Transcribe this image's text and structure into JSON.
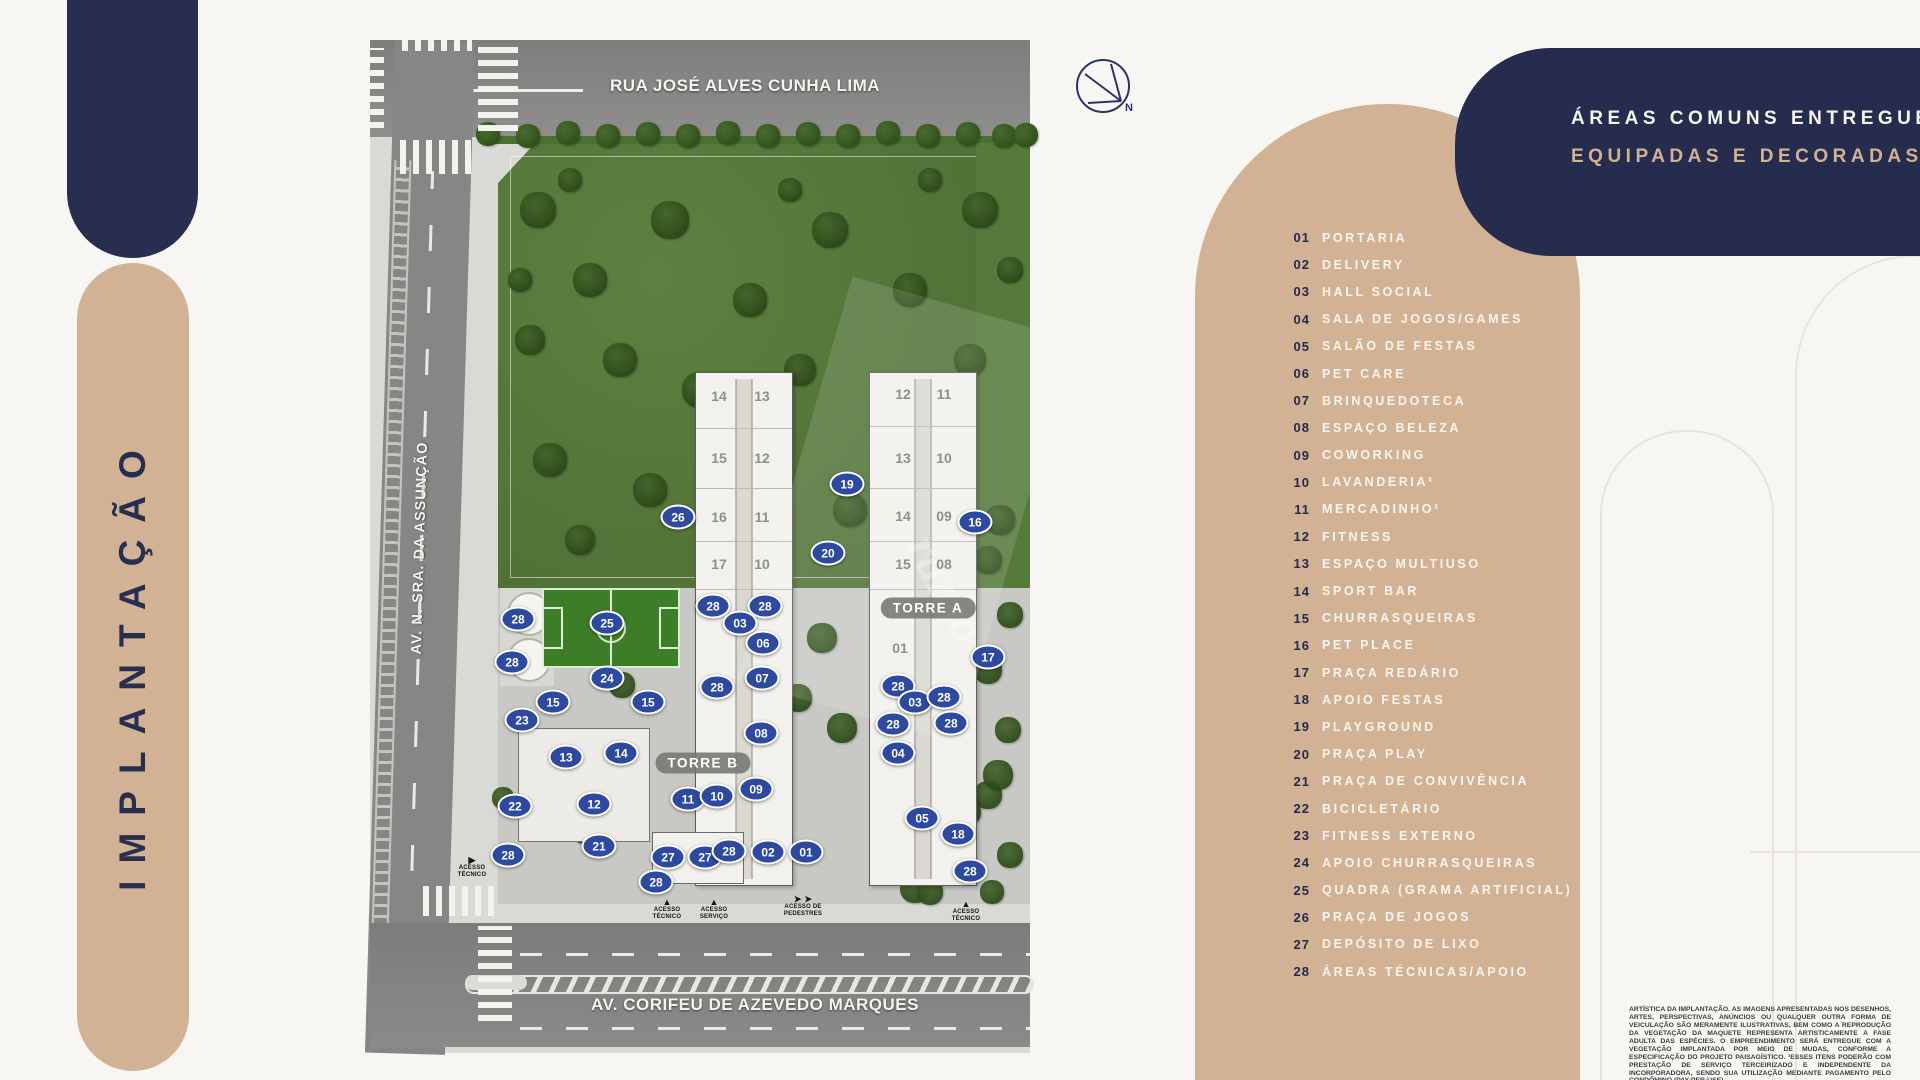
{
  "page": {
    "vertical_title": "IMPLANTAÇÃO"
  },
  "colors": {
    "navy": "#272e50",
    "tan": "#d2b294",
    "marker_blue": "#2d4a9e",
    "lawn_green": "#567a3b"
  },
  "header_card": {
    "line1": "ÁREAS COMUNS ENTREGUES",
    "line2": "EQUIPADAS E DECORADAS."
  },
  "compass": {
    "label": "N"
  },
  "legend": {
    "items": [
      {
        "num": "01",
        "label": "PORTARIA"
      },
      {
        "num": "02",
        "label": "DELIVERY"
      },
      {
        "num": "03",
        "label": "HALL SOCIAL"
      },
      {
        "num": "04",
        "label": "SALA DE JOGOS/GAMES"
      },
      {
        "num": "05",
        "label": "SALÃO DE FESTAS"
      },
      {
        "num": "06",
        "label": "PET CARE"
      },
      {
        "num": "07",
        "label": "BRINQUEDOTECA"
      },
      {
        "num": "08",
        "label": "ESPAÇO BELEZA"
      },
      {
        "num": "09",
        "label": "COWORKING"
      },
      {
        "num": "10",
        "label": "LAVANDERIA¹"
      },
      {
        "num": "11",
        "label": "MERCADINHO¹"
      },
      {
        "num": "12",
        "label": "FITNESS"
      },
      {
        "num": "13",
        "label": "ESPAÇO MULTIUSO"
      },
      {
        "num": "14",
        "label": "SPORT BAR"
      },
      {
        "num": "15",
        "label": "CHURRASQUEIRAS"
      },
      {
        "num": "16",
        "label": "PET PLACE"
      },
      {
        "num": "17",
        "label": "PRAÇA REDÁRIO"
      },
      {
        "num": "18",
        "label": "APOIO FESTAS"
      },
      {
        "num": "19",
        "label": "PLAYGROUND"
      },
      {
        "num": "20",
        "label": "PRAÇA PLAY"
      },
      {
        "num": "21",
        "label": "PRAÇA DE CONVIVÊNCIA"
      },
      {
        "num": "22",
        "label": "BICICLETÁRIO"
      },
      {
        "num": "23",
        "label": "FITNESS EXTERNO"
      },
      {
        "num": "24",
        "label": "APOIO CHURRASQUEIRAS"
      },
      {
        "num": "25",
        "label": "QUADRA (GRAMA ARTIFICIAL)"
      },
      {
        "num": "26",
        "label": "PRAÇA DE JOGOS"
      },
      {
        "num": "27",
        "label": "DEPÓSITO DE LIXO"
      },
      {
        "num": "28",
        "label": "ÁREAS TÉCNICAS/APOIO"
      }
    ]
  },
  "map": {
    "streets": {
      "top": "RUA JOSÉ ALVES CUNHA LIMA",
      "left": "AV. N. SRA. DA ASSUNÇÃO",
      "bottom": "AV. CORIFEU DE AZEVEDO MARQUES"
    },
    "watermark": "razão",
    "tower_labels": [
      {
        "name": "TORRE B",
        "x": 333,
        "y": 723
      },
      {
        "name": "TORRE A",
        "x": 558,
        "y": 568
      }
    ],
    "units": [
      {
        "t": "14",
        "x": 349,
        "y": 356
      },
      {
        "t": "13",
        "x": 392,
        "y": 356
      },
      {
        "t": "15",
        "x": 349,
        "y": 418
      },
      {
        "t": "12",
        "x": 392,
        "y": 418
      },
      {
        "t": "16",
        "x": 349,
        "y": 477
      },
      {
        "t": "11",
        "x": 392,
        "y": 477
      },
      {
        "t": "17",
        "x": 349,
        "y": 524
      },
      {
        "t": "10",
        "x": 392,
        "y": 524
      },
      {
        "t": "12",
        "x": 533,
        "y": 354
      },
      {
        "t": "11",
        "x": 574,
        "y": 354
      },
      {
        "t": "13",
        "x": 533,
        "y": 418
      },
      {
        "t": "10",
        "x": 574,
        "y": 418
      },
      {
        "t": "14",
        "x": 533,
        "y": 476
      },
      {
        "t": "09",
        "x": 574,
        "y": 476
      },
      {
        "t": "15",
        "x": 533,
        "y": 524
      },
      {
        "t": "08",
        "x": 574,
        "y": 524
      },
      {
        "t": "01",
        "x": 530,
        "y": 608
      }
    ],
    "markers": [
      {
        "n": "26",
        "x": 308,
        "y": 477
      },
      {
        "n": "19",
        "x": 477,
        "y": 444
      },
      {
        "n": "20",
        "x": 458,
        "y": 513
      },
      {
        "n": "16",
        "x": 605,
        "y": 482
      },
      {
        "n": "28",
        "x": 343,
        "y": 566
      },
      {
        "n": "28",
        "x": 395,
        "y": 566
      },
      {
        "n": "03",
        "x": 370,
        "y": 583
      },
      {
        "n": "06",
        "x": 393,
        "y": 603
      },
      {
        "n": "28",
        "x": 347,
        "y": 647
      },
      {
        "n": "07",
        "x": 392,
        "y": 638
      },
      {
        "n": "08",
        "x": 391,
        "y": 693
      },
      {
        "n": "09",
        "x": 386,
        "y": 749
      },
      {
        "n": "11",
        "x": 318,
        "y": 759
      },
      {
        "n": "10",
        "x": 347,
        "y": 756
      },
      {
        "n": "28",
        "x": 148,
        "y": 579
      },
      {
        "n": "25",
        "x": 237,
        "y": 583
      },
      {
        "n": "28",
        "x": 142,
        "y": 622
      },
      {
        "n": "24",
        "x": 237,
        "y": 638
      },
      {
        "n": "15",
        "x": 183,
        "y": 662
      },
      {
        "n": "15",
        "x": 278,
        "y": 662
      },
      {
        "n": "23",
        "x": 152,
        "y": 680
      },
      {
        "n": "13",
        "x": 196,
        "y": 717
      },
      {
        "n": "14",
        "x": 251,
        "y": 713
      },
      {
        "n": "22",
        "x": 145,
        "y": 766
      },
      {
        "n": "12",
        "x": 224,
        "y": 764
      },
      {
        "n": "21",
        "x": 229,
        "y": 806
      },
      {
        "n": "28",
        "x": 138,
        "y": 815
      },
      {
        "n": "27",
        "x": 298,
        "y": 817
      },
      {
        "n": "27",
        "x": 335,
        "y": 817
      },
      {
        "n": "28",
        "x": 359,
        "y": 811
      },
      {
        "n": "02",
        "x": 398,
        "y": 812
      },
      {
        "n": "01",
        "x": 436,
        "y": 812
      },
      {
        "n": "28",
        "x": 286,
        "y": 842
      },
      {
        "n": "17",
        "x": 618,
        "y": 617
      },
      {
        "n": "28",
        "x": 528,
        "y": 646
      },
      {
        "n": "03",
        "x": 545,
        "y": 662
      },
      {
        "n": "28",
        "x": 574,
        "y": 657
      },
      {
        "n": "28",
        "x": 523,
        "y": 684
      },
      {
        "n": "28",
        "x": 581,
        "y": 683
      },
      {
        "n": "04",
        "x": 528,
        "y": 713
      },
      {
        "n": "05",
        "x": 552,
        "y": 778
      },
      {
        "n": "18",
        "x": 588,
        "y": 794
      },
      {
        "n": "28",
        "x": 600,
        "y": 831
      }
    ],
    "access": [
      {
        "text": "ACESSO\nTÉCNICO",
        "x": 102,
        "y": 816,
        "arrow": "right"
      },
      {
        "text": "ACESSO\nTÉCNICO",
        "x": 297,
        "y": 858,
        "arrow": "up"
      },
      {
        "text": "ACESSO\nSERVIÇO",
        "x": 344,
        "y": 858,
        "arrow": "up"
      },
      {
        "text": "ACESSO DE\nPEDESTRES",
        "x": 433,
        "y": 855,
        "arrow": "lr"
      },
      {
        "text": "ACESSO\nTÉCNICO",
        "x": 596,
        "y": 860,
        "arrow": "up"
      }
    ],
    "trees": [
      [
        118,
        94,
        24,
        0
      ],
      [
        158,
        96,
        24,
        0
      ],
      [
        198,
        93,
        24,
        0
      ],
      [
        238,
        96,
        24,
        0
      ],
      [
        278,
        94,
        24,
        0
      ],
      [
        318,
        96,
        24,
        0
      ],
      [
        358,
        93,
        24,
        0
      ],
      [
        398,
        96,
        24,
        0
      ],
      [
        438,
        94,
        24,
        0
      ],
      [
        478,
        96,
        24,
        0
      ],
      [
        518,
        93,
        24,
        0
      ],
      [
        558,
        96,
        24,
        0
      ],
      [
        598,
        94,
        24,
        0
      ],
      [
        634,
        96,
        24,
        0
      ],
      [
        656,
        95,
        24,
        0
      ],
      [
        168,
        170,
        36,
        1
      ],
      [
        220,
        240,
        34,
        1
      ],
      [
        300,
        180,
        38,
        1
      ],
      [
        380,
        260,
        34,
        1
      ],
      [
        460,
        190,
        36,
        1
      ],
      [
        540,
        250,
        34,
        1
      ],
      [
        610,
        170,
        36,
        1
      ],
      [
        250,
        320,
        34,
        1
      ],
      [
        330,
        350,
        36,
        1
      ],
      [
        430,
        330,
        32,
        1
      ],
      [
        520,
        380,
        36,
        1
      ],
      [
        600,
        320,
        32,
        1
      ],
      [
        180,
        420,
        34,
        1
      ],
      [
        280,
        450,
        34,
        1
      ],
      [
        390,
        430,
        32,
        1
      ],
      [
        480,
        470,
        34,
        1
      ],
      [
        570,
        440,
        32,
        1
      ],
      [
        630,
        480,
        30,
        1
      ],
      [
        160,
        300,
        30,
        1
      ],
      [
        210,
        500,
        30,
        1
      ],
      [
        350,
        500,
        30,
        1
      ],
      [
        200,
        140,
        24,
        1
      ],
      [
        420,
        150,
        24,
        1
      ],
      [
        560,
        140,
        24,
        1
      ],
      [
        640,
        230,
        26,
        1
      ],
      [
        150,
        240,
        24,
        1
      ],
      [
        618,
        520,
        28,
        1
      ],
      [
        640,
        575,
        26,
        1
      ],
      [
        618,
        630,
        28,
        1
      ],
      [
        638,
        690,
        26,
        1
      ],
      [
        618,
        755,
        28,
        1
      ],
      [
        640,
        815,
        26,
        1
      ],
      [
        452,
        598,
        30,
        1
      ],
      [
        428,
        658,
        28,
        1
      ],
      [
        472,
        688,
        30,
        1
      ],
      [
        252,
        645,
        26,
        1
      ],
      [
        162,
        700,
        24,
        1
      ],
      [
        628,
        735,
        30,
        1
      ],
      [
        215,
        790,
        28,
        1
      ],
      [
        545,
        848,
        30,
        1
      ],
      [
        598,
        772,
        26,
        1
      ],
      [
        133,
        758,
        22,
        1
      ],
      [
        560,
        852,
        26,
        1
      ],
      [
        622,
        852,
        24,
        1
      ]
    ]
  },
  "disclaimer": "ARTÍSTICA DA IMPLANTAÇÃO. AS IMAGENS APRESENTADAS NOS DESENHOS, ARTES, PERSPECTIVAS, ANÚNCIOS OU QUALQUER OUTRA FORMA DE VEICULAÇÃO SÃO MERAMENTE ILUSTRATIVAS, BEM COMO A REPRODUÇÃO DA VEGETAÇÃO DA MAQUETE REPRESENTA ARTISTICAMENTE A FASE ADULTA DAS ESPÉCIES. O EMPREENDIMENTO SERÁ ENTREGUE COM A VEGETAÇÃO IMPLANTADA POR MEIO DE MUDAS, CONFORME A ESPECIFICAÇÃO DO PROJETO PAISAGÍSTICO. ¹ESSES ITENS PODERÃO COM PRESTAÇÃO DE SERVIÇO TERCEIRIZADO E INDEPENDENTE DA INCORPORADORA, SENDO SUA UTILIZAÇÃO MEDIANTE PAGAMENTO PELO CONDÔMINO (PAY-PER-USE)."
}
